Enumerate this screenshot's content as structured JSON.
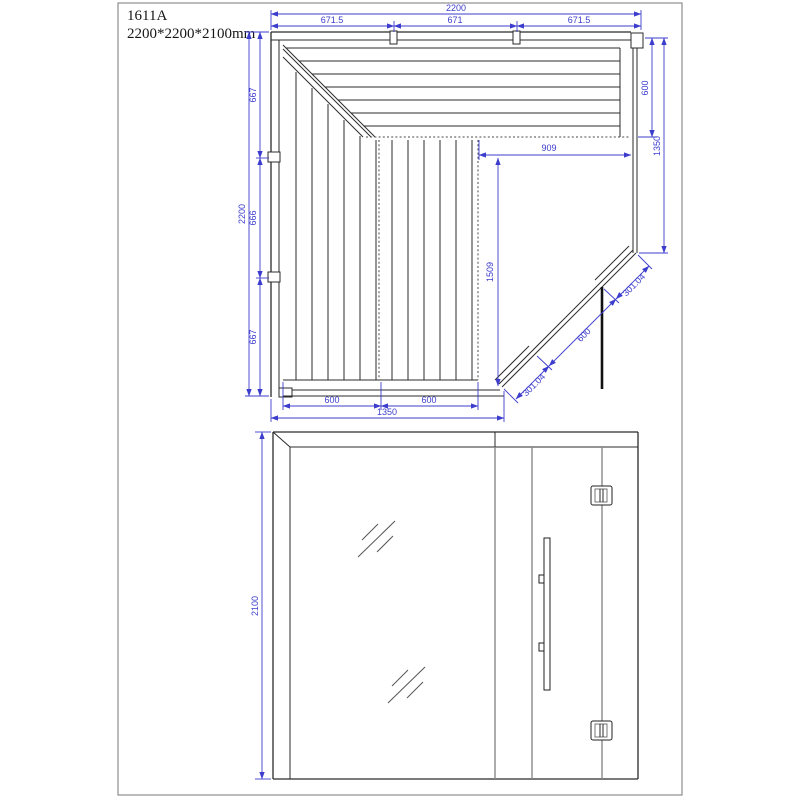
{
  "sheet": {
    "model": "1611A",
    "overall_size": "2200*2200*2100mm"
  },
  "colors": {
    "dimension_blue": "#3d3dcd",
    "drawing_line": "#2b2b2b",
    "background": "#ffffff"
  },
  "plan_view": {
    "dims": {
      "top_total": "2200",
      "top_seg_1": "671.5",
      "top_seg_2": "671",
      "top_seg_3": "671.5",
      "left_total": "2200",
      "left_seg_1": "667",
      "left_seg_2": "666",
      "left_seg_3": "667",
      "bench_depth": "600",
      "right_wall": "1350",
      "floor_width": "909",
      "floor_depth": "1509",
      "door_glass_top": "301.04",
      "door_width": "600",
      "door_glass_bottom": "301.04",
      "bottom_seg_1": "600",
      "bottom_seg_2": "600",
      "bottom_total": "1350"
    }
  },
  "front_view": {
    "dims": {
      "height": "2100"
    }
  }
}
